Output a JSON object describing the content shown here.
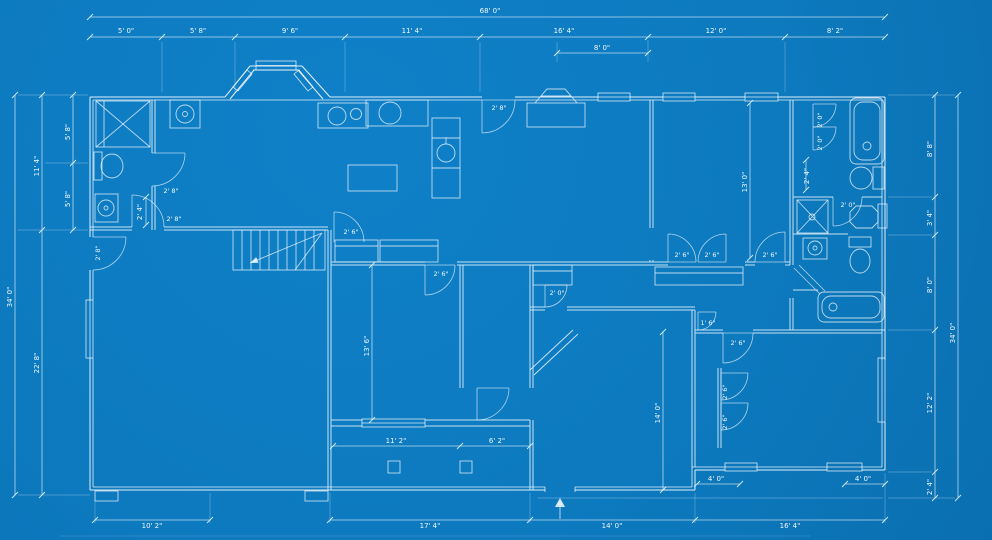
{
  "app": {
    "type": "architectural-blueprint",
    "drawing": "single-story house floor plan"
  },
  "colors": {
    "background": "#0d7abf",
    "background_edge": "#0a6fb0",
    "line": "#ecf6fc"
  },
  "dims": {
    "overall_width": "68' 0\"",
    "top_segments": [
      "5' 0\"",
      "5' 8\"",
      "9' 6\"",
      "11' 4\"",
      "16' 4\"",
      "12' 0\"",
      "8' 2\""
    ],
    "top_sub_segment": "8' 0\"",
    "left_overall": "34' 0\"",
    "left_segments": [
      "11' 4\"",
      "22' 8\""
    ],
    "left_inner_segments": [
      "5' 8\"",
      "5' 8\""
    ],
    "right_overall": "34' 0\"",
    "right_segments": [
      "8' 8\"",
      "3' 4\"",
      "8' 0\"",
      "12' 2\"",
      "2' 4\""
    ],
    "bottom_segments": [
      "10' 2\"",
      "17' 4\"",
      "14' 0\"",
      "16' 4\""
    ],
    "interior": {
      "bedroom2_width": "11' 2\"",
      "hall_width": "6' 2\"",
      "bedroom2_depth": "13' 6\"",
      "bedroom3_depth": "13' 0\"",
      "bedroom4_depth": "14' 0\"",
      "porch_left": "4' 0\"",
      "porch_right": "4' 0\"",
      "closet_left": "2' 4\"",
      "closet_right": "2' 4\""
    }
  },
  "doors": {
    "laundry_a": "2' 8\"",
    "laundry_b": "2' 8\"",
    "side_entry": "2' 8\"",
    "rear_entry": "2' 8\"",
    "kitchen": "2' 6\"",
    "bedroom2": "2' 6\"",
    "hall": "2' 0\"",
    "closet_left": "2' 6\"",
    "closet_right": "2' 6\"",
    "bedroom3": "2' 6\"",
    "bifold_a": "2' 0\"",
    "bifold_b": "2' 0\"",
    "bath": "2' 0\"",
    "linen": "1' 6\"",
    "bedroom4": "2' 6\"",
    "bedroom4_closet_a": "2' 6\"",
    "bedroom4_closet_b": "2' 6\""
  }
}
